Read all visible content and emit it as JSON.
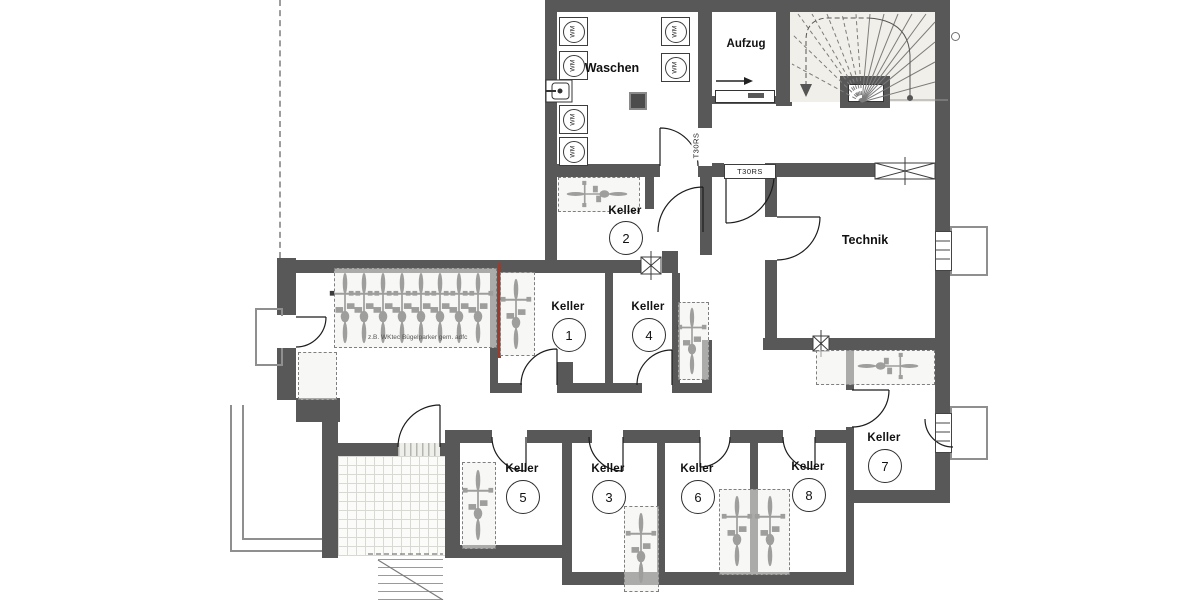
{
  "rooms": {
    "waschen": {
      "label": "Waschen"
    },
    "aufzug": {
      "label": "Aufzug"
    },
    "technik": {
      "label": "Technik"
    },
    "keller_1": {
      "label": "Keller",
      "number": "1"
    },
    "keller_2": {
      "label": "Keller",
      "number": "2"
    },
    "keller_3": {
      "label": "Keller",
      "number": "3"
    },
    "keller_4": {
      "label": "Keller",
      "number": "4"
    },
    "keller_5": {
      "label": "Keller",
      "number": "5"
    },
    "keller_6": {
      "label": "Keller",
      "number": "6"
    },
    "keller_7": {
      "label": "Keller",
      "number": "7"
    },
    "keller_8": {
      "label": "Keller",
      "number": "8"
    }
  },
  "doors": {
    "fire_door_label": "T30RS"
  },
  "appliances": {
    "washing_machine_label": "WM"
  },
  "annotations": {
    "bike_parking_note": "z.B. WKtec Bügelparker gem. adfc"
  },
  "colors": {
    "wall": "#585858",
    "stair-fill": "#f1efe9",
    "fire-line": "#9c3a2c",
    "dash": "#7f7f7f"
  }
}
